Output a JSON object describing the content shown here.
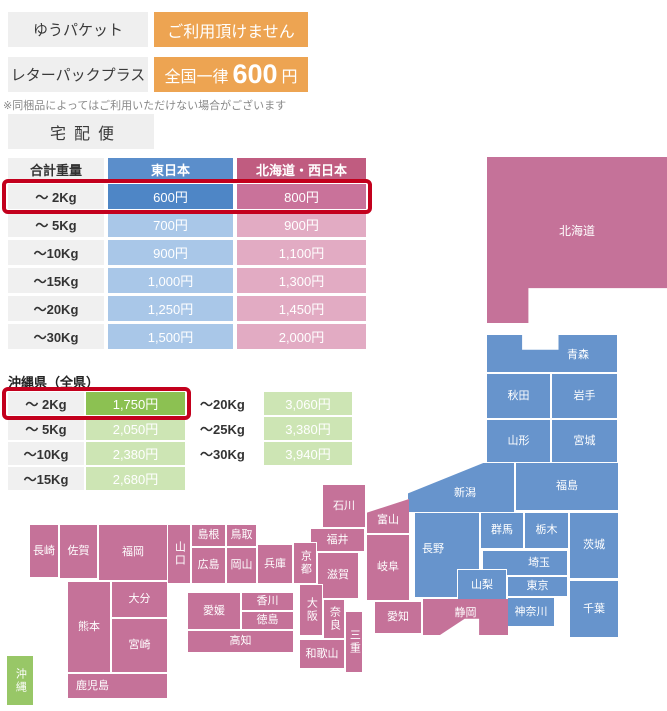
{
  "services": {
    "yupacket": {
      "label": "ゆうパケット",
      "value": "ご利用頂けません"
    },
    "letterpack": {
      "label": "レターパックプラス",
      "prefix": "全国一律",
      "amount": "600",
      "suffix": "円"
    },
    "note": "※同梱品によってはご利用いただけない場合がございます",
    "courier": "宅配便"
  },
  "main_table": {
    "headers": [
      "合計重量",
      "東日本",
      "北海道・西日本"
    ],
    "rows": [
      {
        "weight": "～ 2Kg",
        "east": "600円",
        "west": "800円",
        "highlight": true
      },
      {
        "weight": "～ 5Kg",
        "east": "700円",
        "west": "900円"
      },
      {
        "weight": "～10Kg",
        "east": "900円",
        "west": "1,100円"
      },
      {
        "weight": "～15Kg",
        "east": "1,000円",
        "west": "1,300円"
      },
      {
        "weight": "～20Kg",
        "east": "1,250円",
        "west": "1,450円"
      },
      {
        "weight": "～30Kg",
        "east": "1,500円",
        "west": "2,000円"
      }
    ]
  },
  "okinawa_table": {
    "title": "沖縄県（全県）",
    "left_rows": [
      {
        "weight": "～ 2Kg",
        "price": "1,750円",
        "highlight": true
      },
      {
        "weight": "～ 5Kg",
        "price": "2,050円"
      },
      {
        "weight": "～10Kg",
        "price": "2,380円"
      },
      {
        "weight": "～15Kg",
        "price": "2,680円"
      }
    ],
    "right_rows": [
      {
        "weight": "～20Kg",
        "price": "3,060円"
      },
      {
        "weight": "～25Kg",
        "price": "3,380円"
      },
      {
        "weight": "～30Kg",
        "price": "3,940円"
      }
    ]
  },
  "colors": {
    "orange": "#eda452",
    "east_blue_header": "#5b8ecb",
    "east_blue_strong": "#4e86c6",
    "east_blue_light": "#a9c7e8",
    "west_pink_header": "#c05c80",
    "west_pink_strong": "#c9729a",
    "west_pink_light": "#e2abc3",
    "okinawa_green_strong": "#8cc152",
    "okinawa_green_light": "#cde5b4",
    "map_east": "#6794cc",
    "map_west": "#c57299",
    "map_okinawa": "#98c767",
    "highlight_red": "#c3001d",
    "gray_box": "#efefef"
  },
  "map": {
    "prefectures": [
      {
        "id": "hokkaido",
        "name": "北海道",
        "region": "west",
        "x": 487,
        "y": 157,
        "w": 180,
        "h": 166,
        "fs": 12,
        "dy": -8,
        "clip": "polygon(0% 0%,100% 0%,100% 79%,23% 79%,23% 100%,0% 100%)"
      },
      {
        "id": "aomori",
        "name": "青森",
        "region": "east",
        "x": 487,
        "y": 335,
        "w": 130,
        "h": 37,
        "dx": 26,
        "dy": 2,
        "clip": "polygon(0 0,27% 0,27% 40%,55% 40%,55% 0,100% 0,100% 100%,0 100%)"
      },
      {
        "id": "akita",
        "name": "秋田",
        "region": "east",
        "x": 487,
        "y": 374,
        "w": 63,
        "h": 44
      },
      {
        "id": "iwate",
        "name": "岩手",
        "region": "east",
        "x": 552,
        "y": 374,
        "w": 65,
        "h": 44
      },
      {
        "id": "yamagata",
        "name": "山形",
        "region": "east",
        "x": 487,
        "y": 420,
        "w": 63,
        "h": 42
      },
      {
        "id": "miyagi",
        "name": "宮城",
        "region": "east",
        "x": 552,
        "y": 420,
        "w": 65,
        "h": 42
      },
      {
        "id": "niigata",
        "name": "新潟",
        "region": "east",
        "x": 408,
        "y": 463,
        "w": 106,
        "h": 49,
        "dx": 4,
        "dy": 6,
        "clip": "polygon(0 62%,71% 0,100% 0,100% 100%,0 100%)"
      },
      {
        "id": "fukushima",
        "name": "福島",
        "region": "east",
        "x": 516,
        "y": 463,
        "w": 102,
        "h": 47
      },
      {
        "id": "nagano",
        "name": "長野",
        "region": "east",
        "x": 415,
        "y": 513,
        "w": 64,
        "h": 84,
        "dx": -14,
        "dy": -6
      },
      {
        "id": "gunma",
        "name": "群馬",
        "region": "east",
        "x": 481,
        "y": 513,
        "w": 42,
        "h": 35
      },
      {
        "id": "tochigi",
        "name": "栃木",
        "region": "east",
        "x": 525,
        "y": 513,
        "w": 43,
        "h": 35
      },
      {
        "id": "ibaraki",
        "name": "茨城",
        "region": "east",
        "x": 570,
        "y": 513,
        "w": 48,
        "h": 65
      },
      {
        "id": "saitama",
        "name": "埼玉",
        "region": "east",
        "x": 483,
        "y": 551,
        "w": 84,
        "h": 24,
        "dx": 14
      },
      {
        "id": "yamanashi",
        "name": "山梨",
        "region": "east",
        "x": 458,
        "y": 570,
        "w": 48,
        "h": 30
      },
      {
        "id": "tokyo",
        "name": "東京",
        "region": "east",
        "x": 508,
        "y": 577,
        "w": 59,
        "h": 19
      },
      {
        "id": "kanagawa",
        "name": "神奈川",
        "region": "east",
        "x": 508,
        "y": 598,
        "w": 46,
        "h": 28
      },
      {
        "id": "chiba",
        "name": "千葉",
        "region": "east",
        "x": 570,
        "y": 581,
        "w": 48,
        "h": 56
      },
      {
        "id": "ishikawa",
        "name": "石川",
        "region": "west",
        "x": 323,
        "y": 485,
        "w": 42,
        "h": 42
      },
      {
        "id": "toyama",
        "name": "富山",
        "region": "west",
        "x": 367,
        "y": 499,
        "w": 42,
        "h": 34,
        "dy": 4,
        "clip": "polygon(0 40%,100% 0,100% 100%,0 100%)"
      },
      {
        "id": "fukui",
        "name": "福井",
        "region": "west",
        "x": 311,
        "y": 529,
        "w": 53,
        "h": 22
      },
      {
        "id": "gifu",
        "name": "岐阜",
        "region": "west",
        "x": 367,
        "y": 535,
        "w": 42,
        "h": 65
      },
      {
        "id": "kyoto",
        "name": "京都",
        "region": "west",
        "vertical": true,
        "x": 294,
        "y": 543,
        "w": 22,
        "h": 40
      },
      {
        "id": "shiga",
        "name": "滋賀",
        "region": "west",
        "x": 318,
        "y": 553,
        "w": 40,
        "h": 45
      },
      {
        "id": "osaka",
        "name": "大阪",
        "region": "west",
        "vertical": true,
        "x": 300,
        "y": 585,
        "w": 22,
        "h": 50
      },
      {
        "id": "nara",
        "name": "奈良",
        "region": "west",
        "vertical": true,
        "x": 324,
        "y": 600,
        "w": 20,
        "h": 38
      },
      {
        "id": "mie",
        "name": "三重",
        "region": "west",
        "vertical": true,
        "x": 346,
        "y": 612,
        "w": 16,
        "h": 60
      },
      {
        "id": "wakayama",
        "name": "和歌山",
        "region": "west",
        "x": 300,
        "y": 640,
        "w": 44,
        "h": 28
      },
      {
        "id": "hyogo",
        "name": "兵庫",
        "region": "west",
        "x": 258,
        "y": 545,
        "w": 34,
        "h": 38
      },
      {
        "id": "tottori",
        "name": "鳥取",
        "region": "west",
        "x": 227,
        "y": 525,
        "w": 29,
        "h": 21
      },
      {
        "id": "shimane",
        "name": "島根",
        "region": "west",
        "x": 192,
        "y": 525,
        "w": 33,
        "h": 21
      },
      {
        "id": "hiroshima",
        "name": "広島",
        "region": "west",
        "x": 192,
        "y": 548,
        "w": 33,
        "h": 35
      },
      {
        "id": "okayama",
        "name": "岡山",
        "region": "west",
        "x": 227,
        "y": 548,
        "w": 29,
        "h": 35
      },
      {
        "id": "yamaguchi",
        "name": "山口",
        "region": "west",
        "vertical": true,
        "x": 168,
        "y": 525,
        "w": 22,
        "h": 58
      },
      {
        "id": "kagawa",
        "name": "香川",
        "region": "west",
        "x": 242,
        "y": 593,
        "w": 51,
        "h": 17
      },
      {
        "id": "tokushima",
        "name": "徳島",
        "region": "west",
        "x": 242,
        "y": 612,
        "w": 51,
        "h": 17
      },
      {
        "id": "ehime",
        "name": "愛媛",
        "region": "west",
        "x": 188,
        "y": 593,
        "w": 52,
        "h": 36
      },
      {
        "id": "kochi",
        "name": "高知",
        "region": "west",
        "x": 188,
        "y": 631,
        "w": 105,
        "h": 21
      },
      {
        "id": "aichi",
        "name": "愛知",
        "region": "west",
        "x": 375,
        "y": 602,
        "w": 46,
        "h": 31
      },
      {
        "id": "shizuoka",
        "name": "静岡",
        "region": "west",
        "x": 423,
        "y": 599,
        "w": 85,
        "h": 36,
        "dy": -4,
        "clip": "polygon(0 0,100% 0,100% 100%,66% 100%,66% 55%,49% 55%,20% 100%,0 100%)"
      },
      {
        "id": "fukuoka",
        "name": "福岡",
        "region": "west",
        "x": 99,
        "y": 525,
        "w": 68,
        "h": 55
      },
      {
        "id": "saga",
        "name": "佐賀",
        "region": "west",
        "x": 60,
        "y": 525,
        "w": 37,
        "h": 53
      },
      {
        "id": "nagasaki",
        "name": "長崎",
        "region": "west",
        "x": 30,
        "y": 525,
        "w": 28,
        "h": 52
      },
      {
        "id": "oita",
        "name": "大分",
        "region": "west",
        "x": 112,
        "y": 582,
        "w": 55,
        "h": 35
      },
      {
        "id": "kumamoto",
        "name": "熊本",
        "region": "west",
        "x": 68,
        "y": 582,
        "w": 42,
        "h": 90
      },
      {
        "id": "miyazaki",
        "name": "宮崎",
        "region": "west",
        "x": 112,
        "y": 619,
        "w": 55,
        "h": 53
      },
      {
        "id": "kagoshima",
        "name": "鹿児島",
        "region": "west",
        "x": 68,
        "y": 674,
        "w": 99,
        "h": 24,
        "dx": -25
      },
      {
        "id": "okinawa",
        "name": "沖縄",
        "region": "okinawa",
        "vertical": true,
        "x": 7,
        "y": 656,
        "w": 26,
        "h": 49
      }
    ]
  }
}
